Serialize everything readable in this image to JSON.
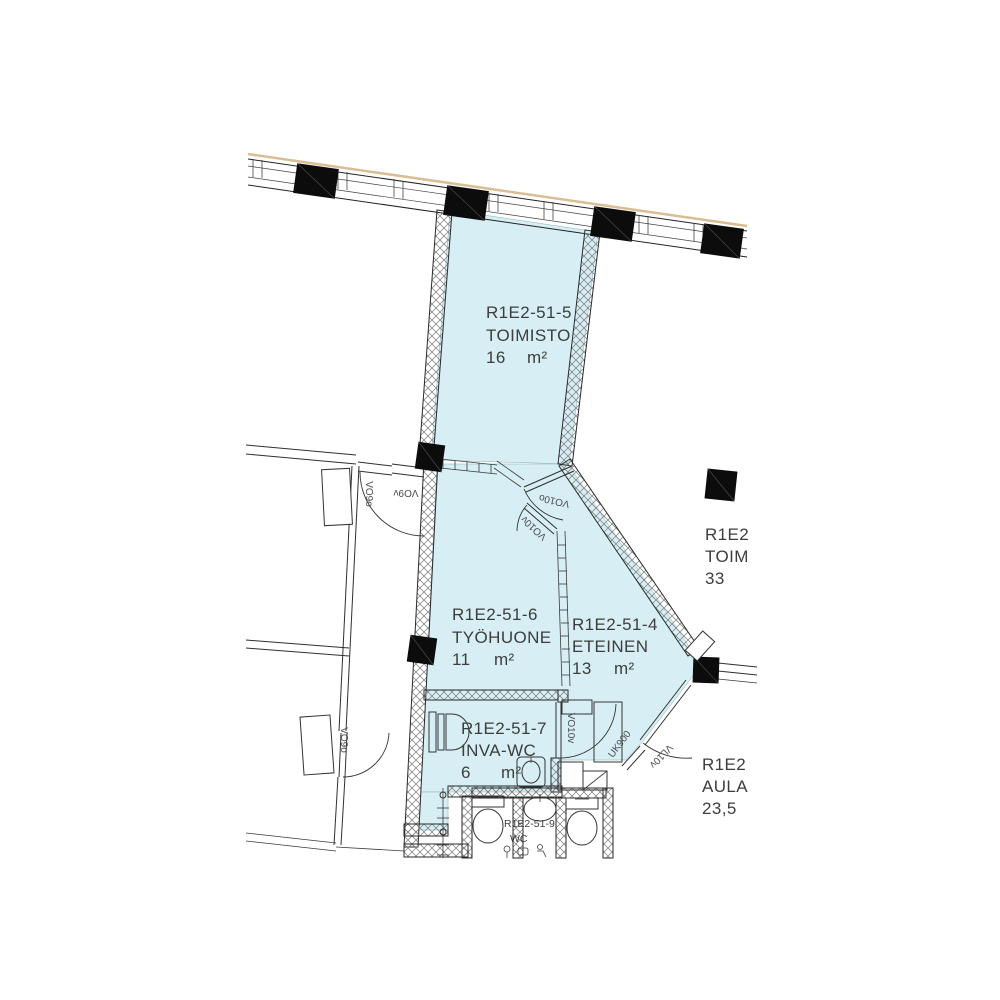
{
  "colors": {
    "room_fill": "#d7eff4",
    "column_fill": "#0c0c0c",
    "facade_line": "#d9bd93",
    "label_text": "#3d3d3d",
    "door_label_text": "#4a4a4a"
  },
  "rooms": {
    "toimisto": {
      "code": "R1E2-51-5",
      "name": "TOIMISTO",
      "area": "16",
      "unit": "m²"
    },
    "tyohuone": {
      "code": "R1E2-51-6",
      "name": "TYÖHUONE",
      "area": "11",
      "unit": "m²"
    },
    "eteinen": {
      "code": "R1E2-51-4",
      "name": "ETEINEN",
      "area": "13",
      "unit": "m²"
    },
    "inva_wc": {
      "code": "R1E2-51-7",
      "name": "INVA-WC",
      "area": "6",
      "unit": "m²"
    },
    "wc": {
      "code": "R1E2-51-9",
      "name": "WC"
    },
    "toim_right": {
      "code": "R1E2",
      "name": "TOIM",
      "area": "33"
    },
    "aula": {
      "code": "R1E2",
      "name": "AULA",
      "area": "23,5"
    }
  },
  "doors": {
    "top_left_a": "VO9o",
    "top_left_b": "VO9v",
    "left": "VO9o",
    "office": "VO10o",
    "hall": "VO10v",
    "inva": "VO10v",
    "exterior": "VL10v"
  },
  "wall_codes": {
    "exterior_diagonal": "UK900"
  }
}
